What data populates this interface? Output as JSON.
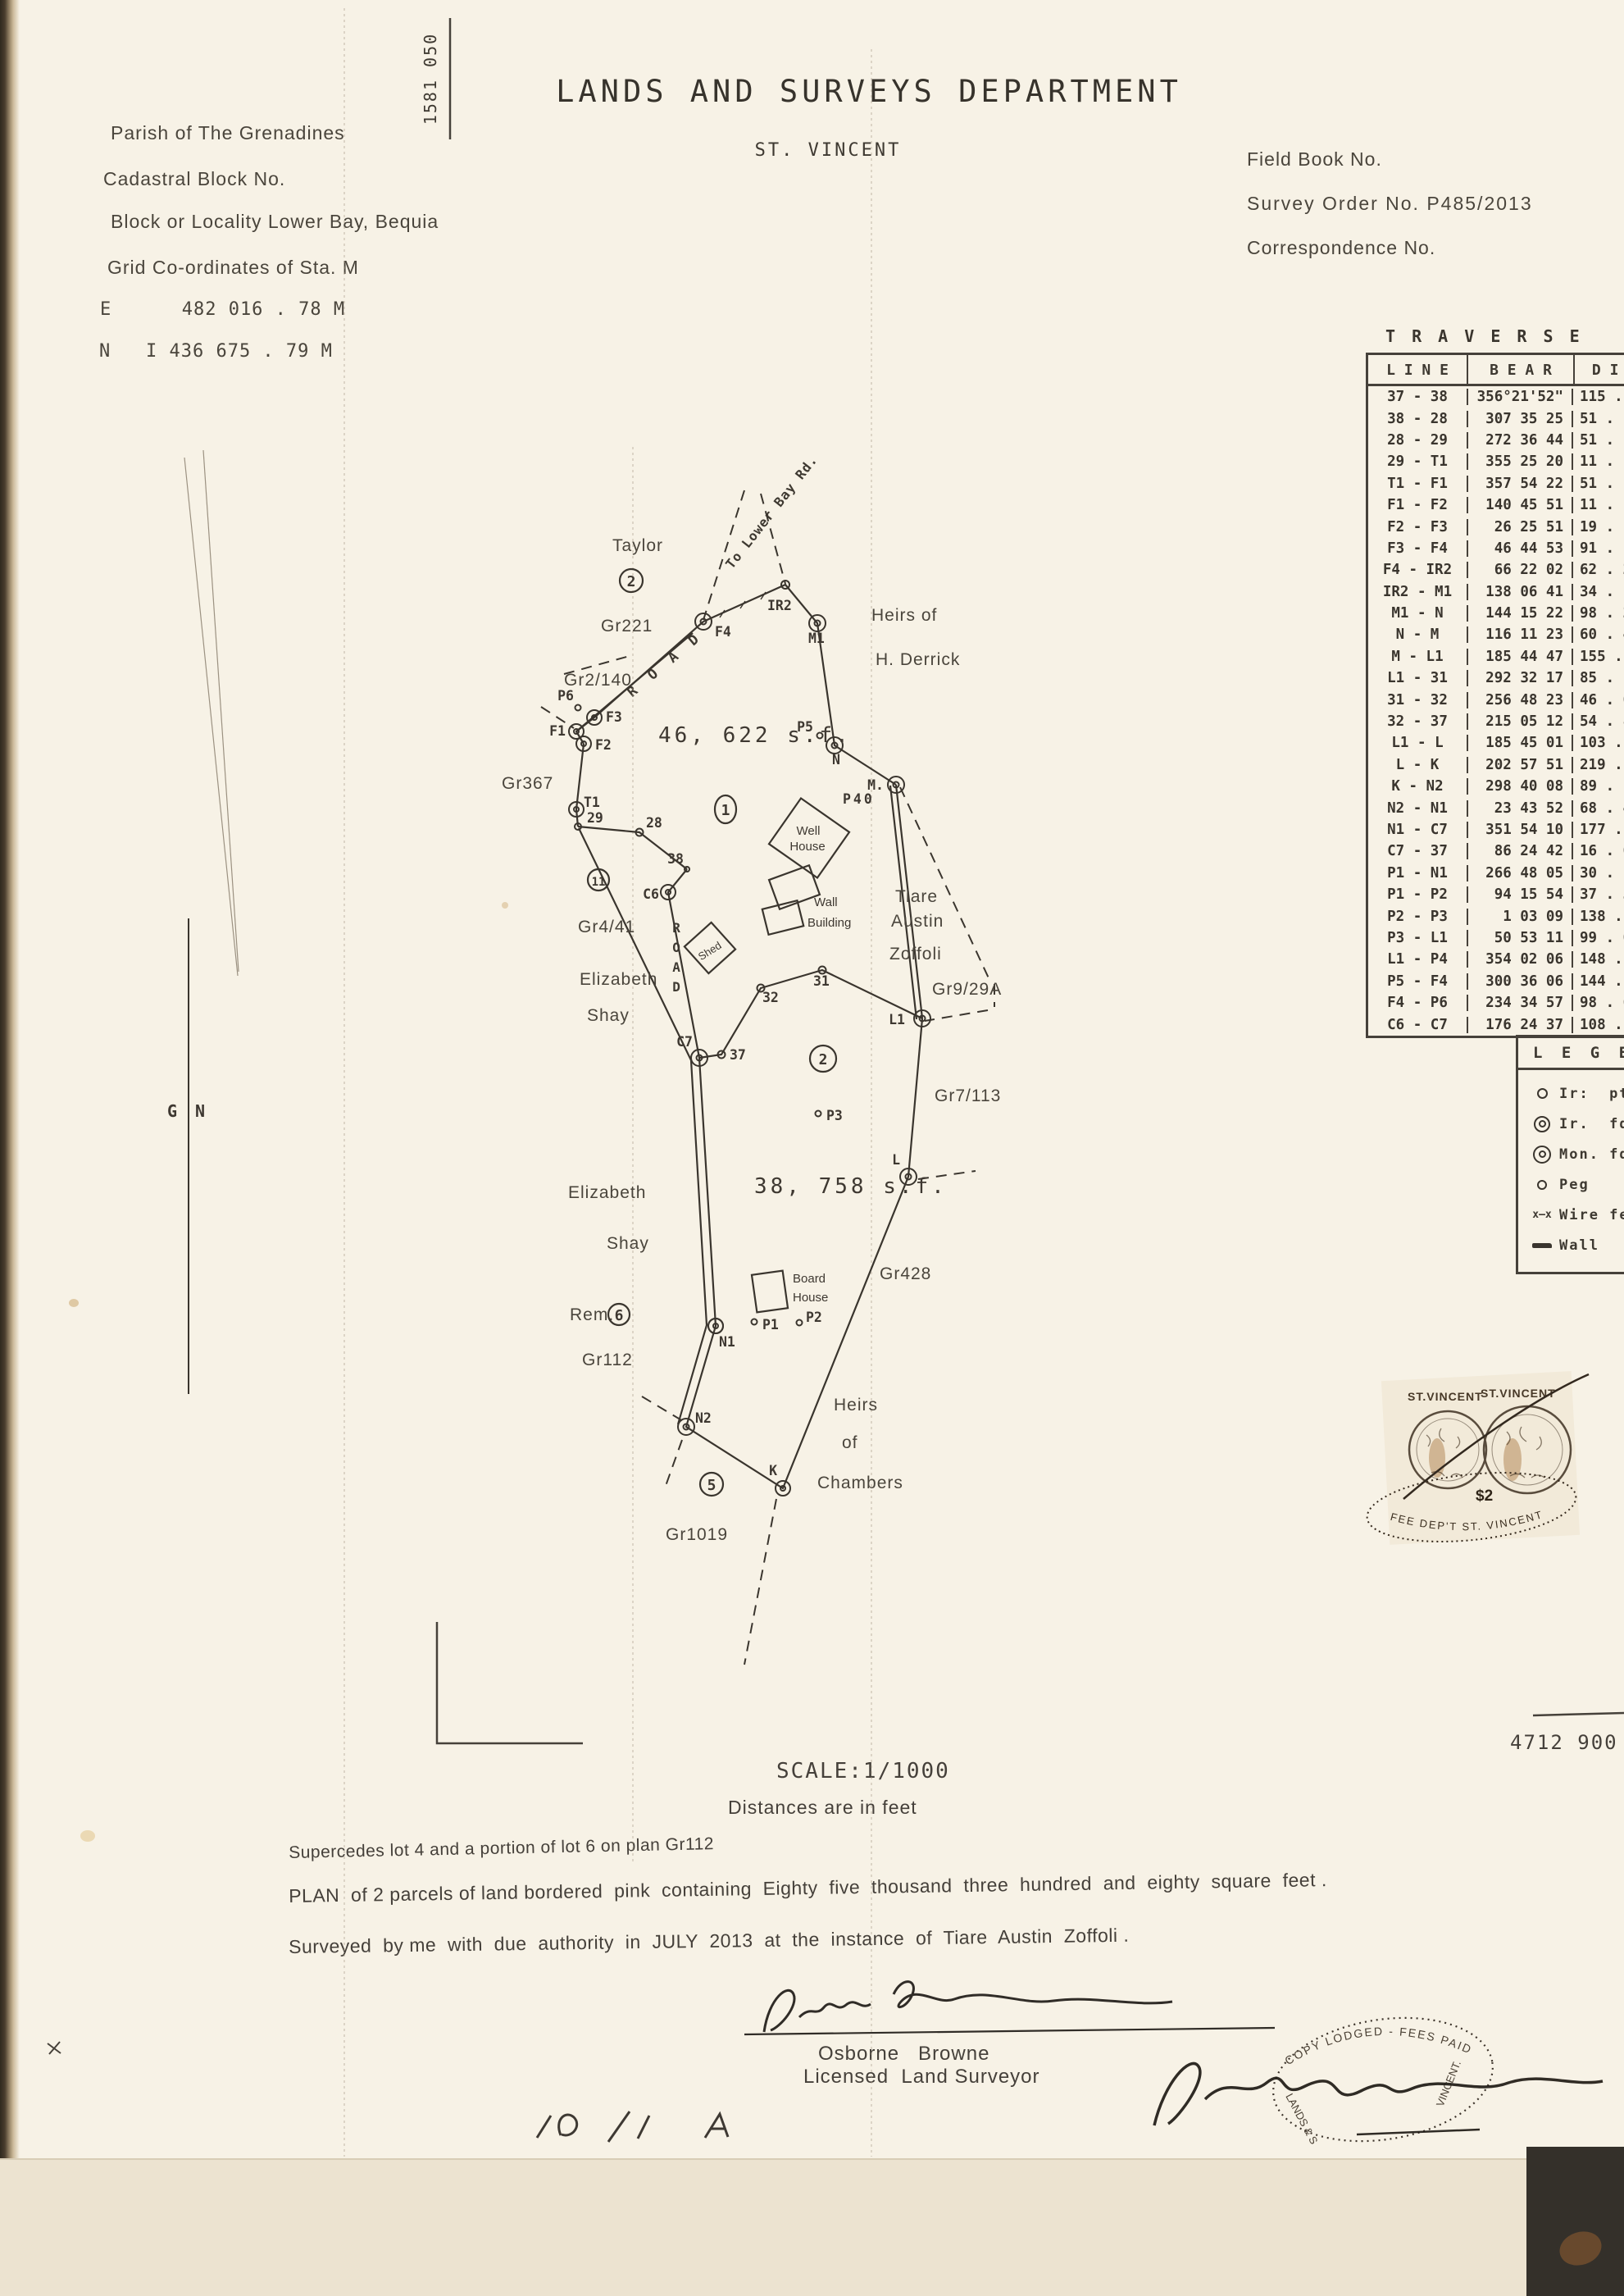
{
  "page": {
    "ref_vertical": "1581 050",
    "sheet_ref": "4712 900"
  },
  "header": {
    "department": "LANDS AND SURVEYS DEPARTMENT",
    "country": "ST. VINCENT",
    "parish": "Parish of The Grenadines",
    "cadastral_block": "Cadastral Block No.",
    "locality": "Block or Locality Lower Bay, Bequia",
    "grid_coords": "Grid Co-ordinates of Sta. M",
    "easting": "E      482 016 . 78 M",
    "northing": "N   I 436 675 . 79 M",
    "field_book": "Field Book No.",
    "survey_order": "Survey Order No. P485/2013",
    "correspondence": "Correspondence No."
  },
  "traverse": {
    "title": "T R A V E R S E",
    "columns": [
      "L I N E",
      "B E A R",
      "D I S"
    ],
    "rows": [
      [
        "37 - 38",
        "356°21'52\"",
        "115 ."
      ],
      [
        "38 - 28",
        "307 35 25",
        "51 ."
      ],
      [
        "28 - 29",
        "272 36 44",
        "51 ."
      ],
      [
        "29 - T1",
        "355 25 20",
        "11 ."
      ],
      [
        "T1 - F1",
        "357 54 22",
        "51 ."
      ],
      [
        "F1 - F2",
        "140 45 51",
        "11 ."
      ],
      [
        "F2 - F3",
        "26 25 51",
        "19 ."
      ],
      [
        "F3 - F4",
        "46 44 53",
        "91 ."
      ],
      [
        "F4 - IR2",
        "66 22 02",
        "62 . 2"
      ],
      [
        "IR2 - M1",
        "138 06 41",
        "34 ."
      ],
      [
        "M1 - N",
        "144 15 22",
        "98 . 2"
      ],
      [
        "N - M",
        "116 11 23",
        "60 . 4"
      ],
      [
        "M - L1",
        "185 44 47",
        "155 . 3"
      ],
      [
        "L1 - 31",
        "292 32 17",
        "85 ."
      ],
      [
        "31 - 32",
        "256 48 23",
        "46 . 0"
      ],
      [
        "32 - 37",
        "215 05 12",
        "54 . 8"
      ],
      [
        "L1 - L",
        "185 45 01",
        "103 . 3"
      ],
      [
        "L - K",
        "202 57 51",
        "219 . 6"
      ],
      [
        "K - N2",
        "298 40 08",
        "89 . 1"
      ],
      [
        "N2 - N1",
        "23 43 52",
        "68 . 4"
      ],
      [
        "N1 - C7",
        "351 54 10",
        "177 . 4"
      ],
      [
        "C7 - 37",
        "86 24 42",
        "16 . 0"
      ],
      [
        "P1 - N1",
        "266 48 05",
        "30 . 1"
      ],
      [
        "P1 - P2",
        "94 15 54",
        "37 . 3"
      ],
      [
        "P2 - P3",
        "1 03 09",
        "138 . 1"
      ],
      [
        "P3 - L1",
        "50 53 11",
        "99 . 0"
      ],
      [
        "L1 - P4",
        "354 02 06",
        "148 . 9"
      ],
      [
        "P5 - F4",
        "300 36 06",
        "144 . 7"
      ],
      [
        "F4 - P6",
        "234 34 57",
        "98 . 6"
      ],
      [
        "C6 - C7",
        "176 24 37",
        "108 . 5"
      ]
    ]
  },
  "legend": {
    "title": "L E G E N D",
    "items": [
      {
        "symbol": "iron-point",
        "label": "Ir:  pt."
      },
      {
        "symbol": "iron-found",
        "label": "Ir.  fd."
      },
      {
        "symbol": "monument-found",
        "label": "Mon. fd."
      },
      {
        "symbol": "peg",
        "label": "Peg"
      },
      {
        "symbol": "wire-fence",
        "glyph": "x—x",
        "label": "Wire fen"
      },
      {
        "symbol": "wall",
        "label": "Wall"
      }
    ]
  },
  "plan": {
    "stations": {
      "f1": "F1",
      "f2": "F2",
      "f3": "F3",
      "f4": "F4",
      "p6": "P6",
      "ir2": "IR2",
      "m1": "M1",
      "n": "N",
      "p5": "P5",
      "m": "M.",
      "t1": "T1",
      "s29": "29",
      "s28": "28",
      "s38": "38",
      "c6": "C6",
      "c7": "C7",
      "s37": "37",
      "s32": "32",
      "s31": "31",
      "l1": "L1",
      "l": "L",
      "k": "K",
      "n1": "N1",
      "n2": "N2",
      "p1": "P1",
      "p2": "P2",
      "p3": "P3"
    },
    "parcels": {
      "one": "1",
      "two": "2",
      "area1": "46, 622  s.f.",
      "area2": "38, 758  s.f."
    },
    "adjacent": {
      "taylor": "Taylor",
      "lot2": "2",
      "gr221": "Gr221",
      "gr2_140": "Gr2/140",
      "gr367": "Gr367",
      "heirs_of": "Heirs  of",
      "h_derrick": "H. Derrick",
      "p40": "P40",
      "tiare": "Tiare",
      "austin": "Austin",
      "zoffoli": "Zoffoli",
      "gr9_29a": "Gr9/29A",
      "gr7_113": "Gr7/113",
      "lot11": "11",
      "gr4_41": "Gr4/41",
      "elizabeth1": "Elizabeth",
      "shay1": "Shay",
      "elizabeth2": "Elizabeth",
      "shay2": "Shay",
      "rem": "Rem.",
      "lot6": "6",
      "gr112": "Gr112",
      "gr428": "Gr428",
      "heirs": "Heirs",
      "of": "of",
      "chambers": "Chambers",
      "lot5": "5",
      "gr1019": "Gr1019"
    },
    "features": {
      "well1": "Well",
      "house1": "House",
      "wall1": "Wall",
      "building1": "Building",
      "shed": "Shed",
      "board": "Board",
      "house2": "House",
      "road1": "R O A D",
      "road2": "ROAD",
      "to_lower_bay": "To Lower Bay Rd.",
      "g": "G",
      "n": "N"
    }
  },
  "footer": {
    "scale": "SCALE:1/1000",
    "distances": "Distances are in feet",
    "supersedes": "Supercedes lot 4 and a portion of lot 6 on plan Gr112",
    "plan_desc": "PLAN  of 2 parcels of land bordered  pink  containing  Eighty  five  thousand  three  hundred  and  eighty  square  feet .",
    "surveyed": "Surveyed  by me  with  due  authority  in  JULY  2013  at  the  instance  of  Tiare  Austin  Zoffoli .",
    "surveyor": "Osborne   Browne",
    "surveyor_title": "Licensed  Land Surveyor"
  },
  "stamps": {
    "revenue": {
      "name1": "ST.VINCENT",
      "name2": "ST.VINCENT",
      "value": "$2",
      "cancel": "FEE DEP'T ST. VINCENT"
    },
    "lodged": {
      "top": "COPY LODGED  -  FEES PAID",
      "left": "LANDS & S",
      "right": "VINCENT."
    }
  }
}
